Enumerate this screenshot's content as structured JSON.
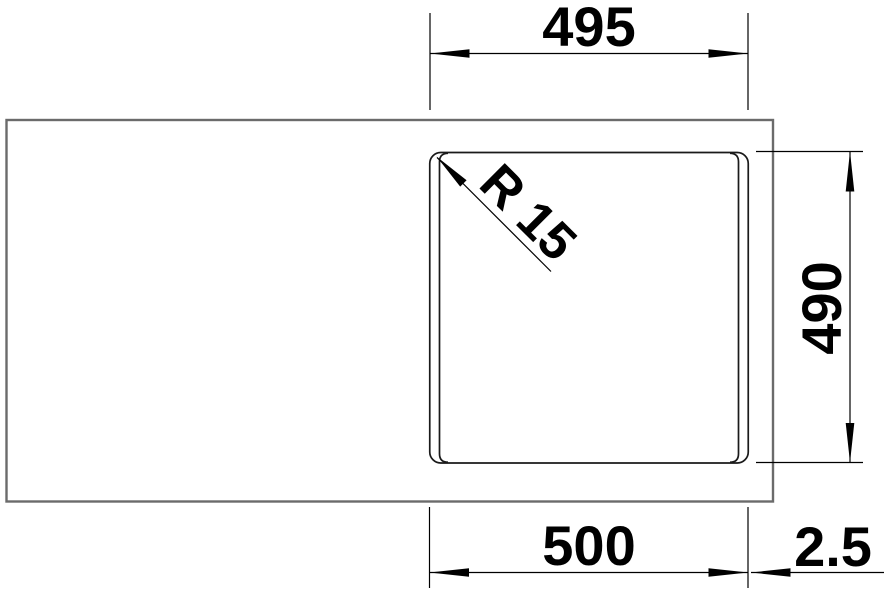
{
  "drawing": {
    "labels": {
      "top_width": "495",
      "right_depth": "490",
      "bottom_width": "500",
      "bottom_offset": "2.5",
      "corner_radius": "R 15"
    },
    "colors": {
      "countertop_outline": "#6b6b6b",
      "dimension_line": "#000000"
    }
  }
}
